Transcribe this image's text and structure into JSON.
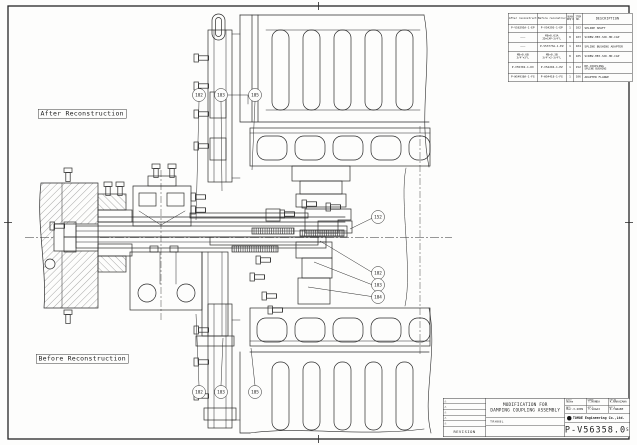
{
  "labels": {
    "after": "After Reconstruction",
    "before": "Before Reconstruction"
  },
  "parts_table": {
    "headers": {
      "after": "After reconstruction",
      "before": "Before reconstruction",
      "quan1": "QUAN",
      "quan2": "REQ'D",
      "item1": "ITEM",
      "item2": "NO.",
      "description": "DESCRIPTION"
    },
    "rows": [
      {
        "after": "P-V56295A-1-EP",
        "before": "P-V54295-1-EP",
        "quan": "1",
        "item": "102",
        "desc": "SPLINE SHAFT"
      },
      {
        "after": "———",
        "before": "M8×0.63A",
        "before2": "2D×CAP-3/4\"L",
        "quan": "8",
        "item": "103",
        "desc": "SCREW-HEX.SOC.HD.CAP"
      },
      {
        "after": "———",
        "before": "P-V53773A-1-EZ",
        "quan": "1",
        "item": "104",
        "desc": "SPLINE BUSHING ADAPTER"
      },
      {
        "after": "M8×0.6B",
        "after2": "3/4\"×3\"L",
        "before": "M8×0.3B",
        "before2": "3/4\"×2-3/4\"L",
        "quan": "8",
        "item": "105",
        "desc": "SCREW-HEX.SOC.HD.CAP"
      },
      {
        "after": "P-V55302-1-DX",
        "before": "P-V54294-1-EZ",
        "quan": "1",
        "item": "152",
        "desc": "RE-COUPLING",
        "desc2": "SPLINE BUSHING"
      },
      {
        "after": "P-W54938A-1-FG",
        "before": "P-W54418-1-FG",
        "quan": "1",
        "item": "106",
        "desc": "ADAPTER FLANGE"
      }
    ]
  },
  "balloons": [
    "102",
    "103",
    "105",
    "152",
    "102",
    "103",
    "104",
    "102",
    "103",
    "105"
  ],
  "title_block": {
    "title_line1": "MODIFICATION FOR",
    "title_line2": "DAMPING COUPLING ASSEMBLY",
    "scale_label": "SCALE",
    "scale_value": "None",
    "drawn_label": "DRAWN",
    "drawn_name": "T.HONDA",
    "checked_label": "CHECKD",
    "checked_name": "K.NAKAZAWA",
    "date_label": "DATE",
    "date_value": "Mar-3-2009",
    "appd_label": "APP'D",
    "appd_name": "T.SUGAI",
    "appd2_label": "APP'D",
    "appd2_name": "K.TANABE",
    "company": "TOMOE Engineering Co.,Ltd.",
    "drawing_number": "P-V56358.0",
    "drawing_number_suffix": "S",
    "revision_label": "REVISION",
    "ref_code": "TRH08L",
    "rev_mark": "△"
  }
}
